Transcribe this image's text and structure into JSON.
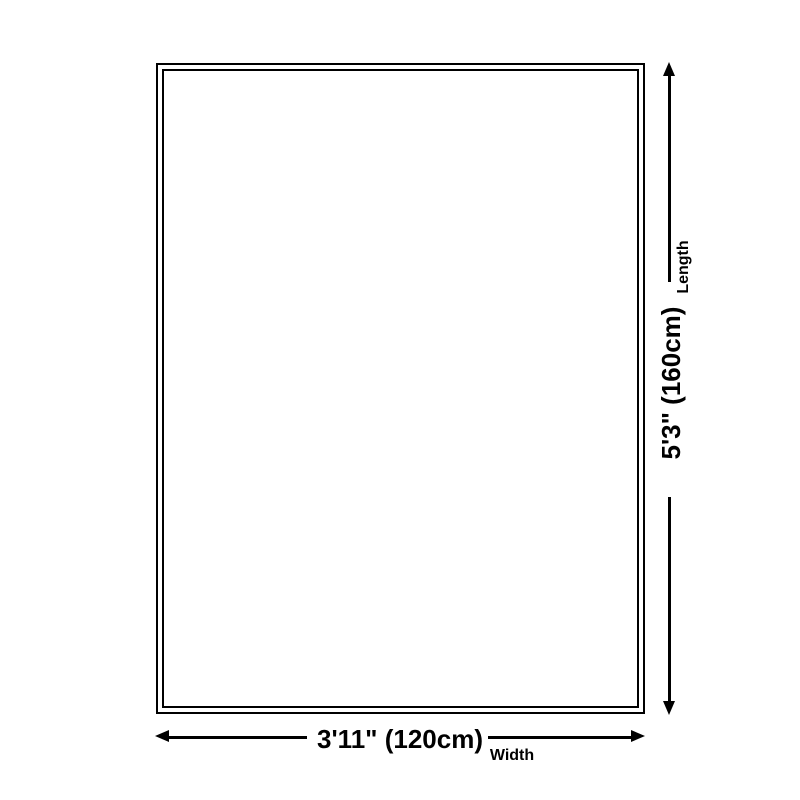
{
  "diagram": {
    "kind": "product-size-diagram",
    "background_color": "#ffffff",
    "line_color": "#000000",
    "rug": {
      "fill_color": "#ffffff",
      "border_color": "#000000",
      "border_style": "double-line"
    },
    "length": {
      "value": "5'3\" (160cm)",
      "label": "Length"
    },
    "width": {
      "value": "3'11\" (120cm)",
      "label": "Width"
    }
  }
}
